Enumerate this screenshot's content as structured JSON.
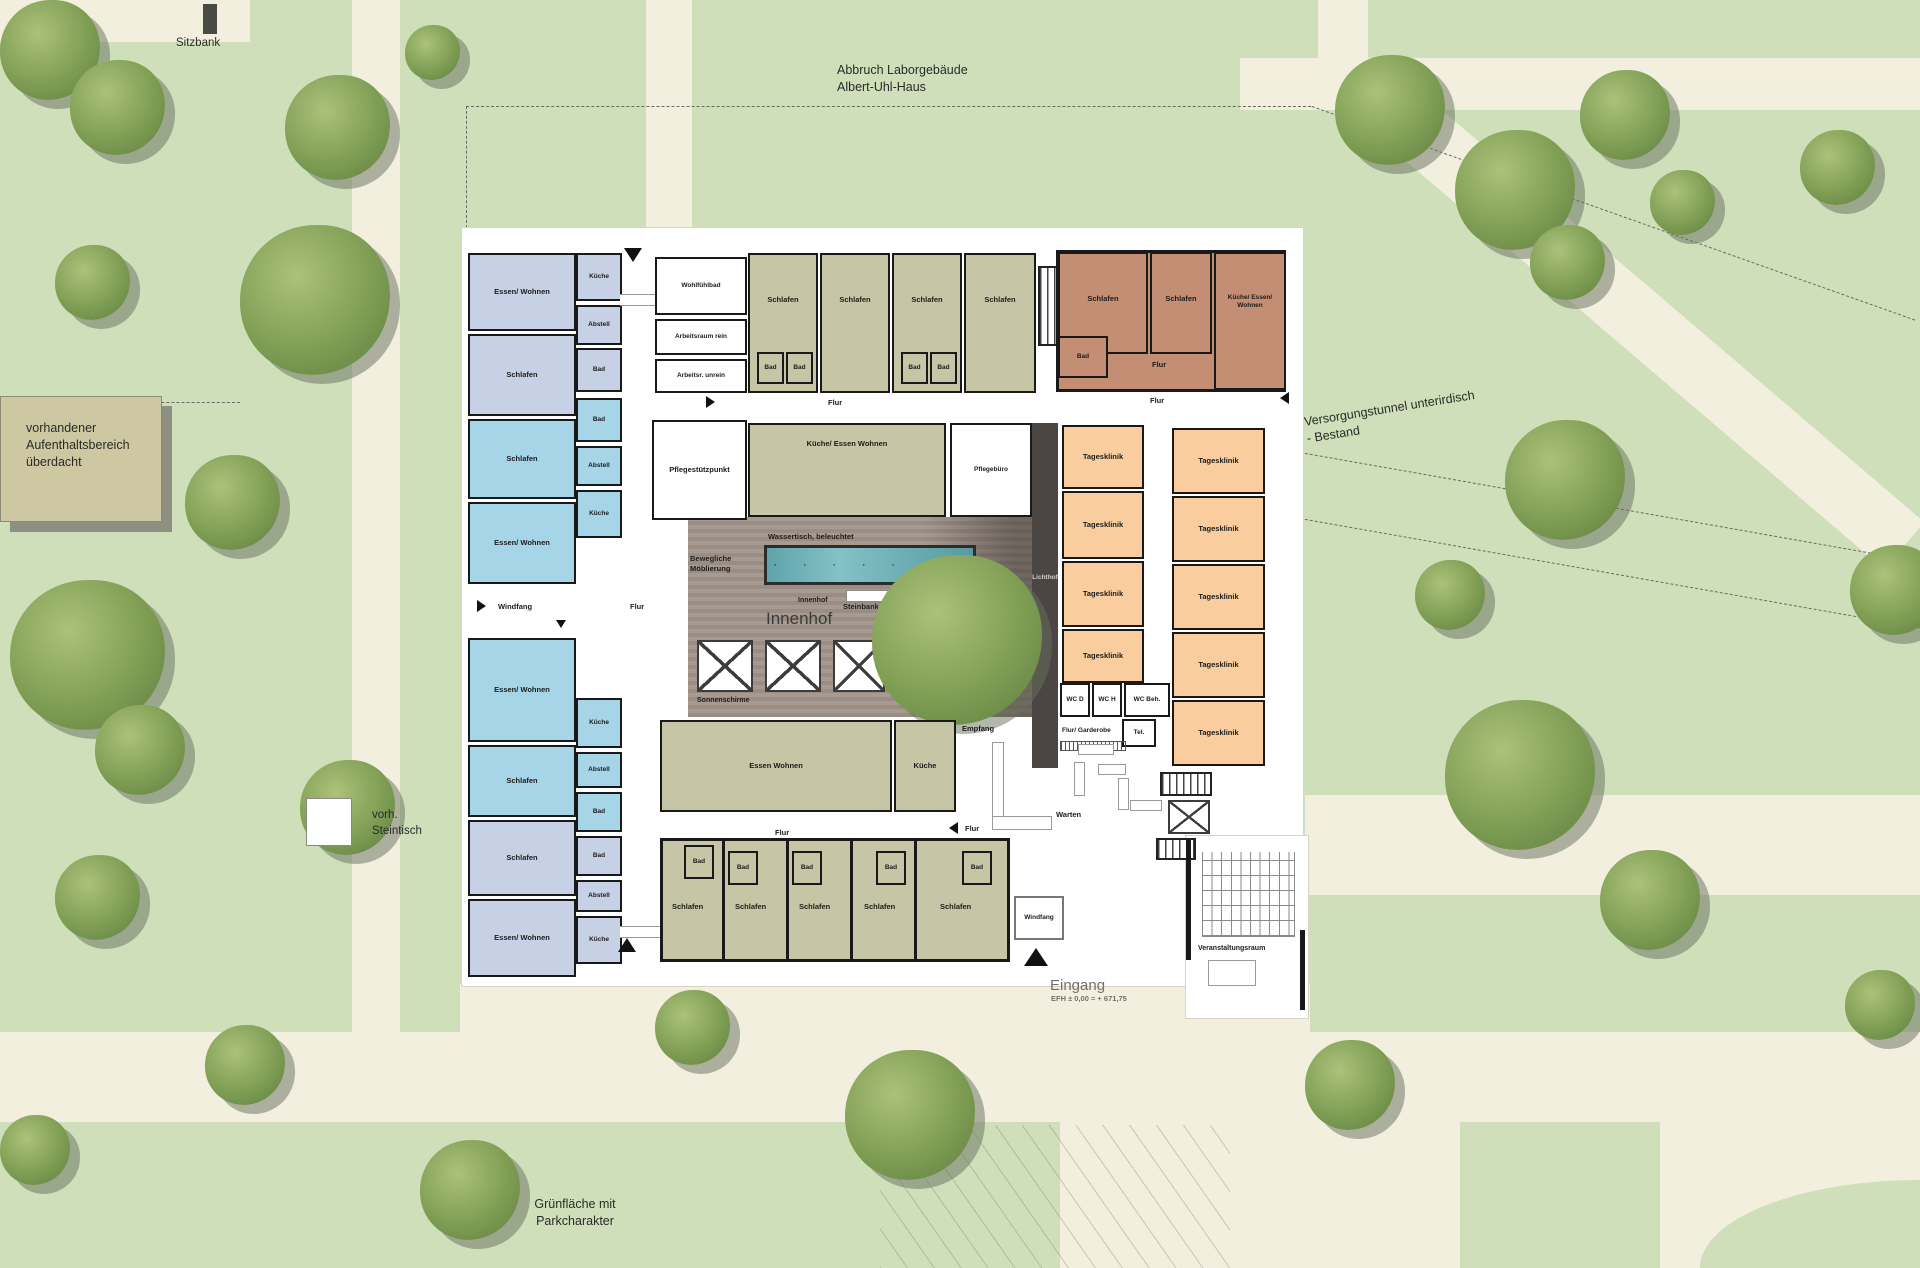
{
  "colors": {
    "site_green": "#cfdfba",
    "path_cream": "#f3efdf",
    "plan_white": "#ffffff",
    "wall_black": "#191919",
    "unit_lavender": "#c7d1e5",
    "unit_blue": "#a6d5e7",
    "unit_olive": "#c6c6a6",
    "unit_brown": "#c48e75",
    "dayclinic_orange": "#f9cd9e",
    "deck_wood": "#9d918a",
    "water_teal": "#6fb3ba",
    "atrium_band": "#4b4643"
  },
  "site": {
    "bench": "Sitzbank",
    "demolition": "Abbruch Laborgebäude\nAlbert-Uhl-Haus",
    "shelter": "vorhandener\nAufenthaltsbereich\nüberdacht",
    "stone_table": "vorh.\nSteintisch",
    "tunnel": "Versorgungstunnel unterirdisch\n- Bestand",
    "lawn": "Grünfläche mit\nParkcharakter",
    "entrance": "Eingang",
    "entrance_level": "EFH ± 0,00 = + 671,75"
  },
  "courtyard": {
    "title_small": "Innenhof",
    "title": "Innenhof",
    "water_table": "Wassertisch, beleuchtet",
    "water_dots": "· · · · · · ·",
    "movable_furniture": "Bewegliche\nMöblierung",
    "stone_bench": "Steinbank",
    "parasols": "Sonnenschirme",
    "light_well": "Lichthof"
  },
  "rooms": {
    "lw1_ew": "Essen/ Wohnen",
    "lw1_kueche": "Küche",
    "lw1_abstell": "Abstell",
    "lw1_schlafen": "Schlafen",
    "lw1_bad": "Bad",
    "lw2_schlafen": "Schlafen",
    "lw2_bad": "Bad",
    "lw2_abstell": "Abstell",
    "lw2_ew": "Essen/ Wohnen",
    "lw2_kueche": "Küche",
    "corridor_windfang": "Windfang",
    "corridor_flur": "Flur",
    "lw3_ew": "Essen/ Wohnen",
    "lw3_kueche": "Küche",
    "lw3_abstell": "Abstell",
    "lw3_schlafen": "Schlafen",
    "lw3_bad": "Bad",
    "lw4_schlafen": "Schlafen",
    "lw4_bad": "Bad",
    "lw4_abstell": "Abstell",
    "lw4_ew": "Essen/ Wohnen",
    "lw4_kueche": "Küche",
    "wohlfuehlbad": "Wohlfühlbad",
    "arbeitsraum_rein": "Arbeitsraum rein",
    "arbeitsraum_unrein": "Arbeitsr. unrein",
    "pflegestuetzpunkt": "Pflegestützpunkt",
    "top_schlafen_1": "Schlafen",
    "top_schlafen_2": "Schlafen",
    "top_schlafen_3": "Schlafen",
    "top_schlafen_4": "Schlafen",
    "top_bad_1": "Bad",
    "top_bad_2": "Bad",
    "top_bad_3": "Bad",
    "top_bad_4": "Bad",
    "top_flur": "Flur",
    "ne_schlafen_1": "Schlafen",
    "ne_schlafen_2": "Schlafen",
    "ne_kew": "Küche/ Essen/ Wohnen",
    "ne_bad": "Bad",
    "ne_flur": "Flur",
    "kew": "Küche/ Essen Wohnen",
    "pflegebuero": "Pflegebüro",
    "right_flur": "Flur",
    "tk_l_1": "Tagesklinik",
    "tk_l_2": "Tagesklinik",
    "tk_l_3": "Tagesklinik",
    "tk_l_4": "Tagesklinik",
    "tk_r_1": "Tagesklinik",
    "tk_r_2": "Tagesklinik",
    "tk_r_3": "Tagesklinik",
    "tk_r_4": "Tagesklinik",
    "tk_r_5": "Tagesklinik",
    "wc_d": "WC D",
    "wc_h": "WC H",
    "wc_beh": "WC Beh.",
    "flur_garderobe": "Flur/ Garderobe",
    "tel": "Tel.",
    "empfang": "Empfang",
    "warten": "Warten",
    "sw_flur": "Flur",
    "bw_ew": "Essen Wohnen",
    "bw_kueche": "Küche",
    "bw_flur": "Flur",
    "bw_bad_1": "Bad",
    "bw_bad_2": "Bad",
    "bw_bad_3": "Bad",
    "bw_bad_4": "Bad",
    "bw_bad_5": "Bad",
    "bw_schlafen_1": "Schlafen",
    "bw_schlafen_2": "Schlafen",
    "bw_schlafen_3": "Schlafen",
    "bw_schlafen_4": "Schlafen",
    "bw_schlafen_5": "Schlafen",
    "windfang_sued": "Windfang",
    "veranstaltungsraum": "Veranstaltungsraum"
  }
}
